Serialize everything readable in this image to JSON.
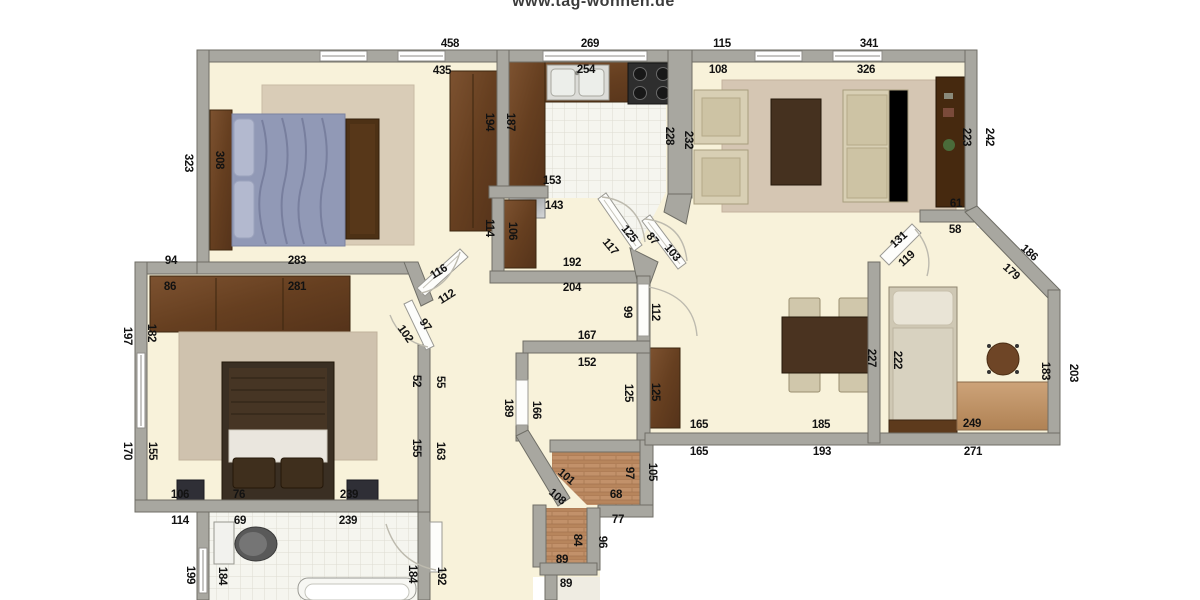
{
  "brand": {
    "url_text": "www.tag-wohnen.de"
  },
  "floorplan": {
    "colors": {
      "wall": "#a8a7a0",
      "wall_edge": "#6f6e66",
      "floor_cream": "#f8f2da",
      "tile": "#f5f5ef",
      "tile_line": "#dddcd2",
      "wood_dark": "#6b4527",
      "rug": "#d7c9b4",
      "bed_blue": "#8d94b2",
      "sofa_cream": "#d8cfb4"
    },
    "labels": [
      {
        "t": "458",
        "x": 450,
        "y": 44
      },
      {
        "t": "269",
        "x": 590,
        "y": 44
      },
      {
        "t": "115",
        "x": 722,
        "y": 44
      },
      {
        "t": "341",
        "x": 869,
        "y": 44
      },
      {
        "t": "435",
        "x": 442,
        "y": 71
      },
      {
        "t": "254",
        "x": 586,
        "y": 70
      },
      {
        "t": "108",
        "x": 718,
        "y": 70
      },
      {
        "t": "326",
        "x": 866,
        "y": 70
      },
      {
        "t": "323",
        "x": 188,
        "y": 163,
        "r": 90
      },
      {
        "t": "308",
        "x": 219,
        "y": 160,
        "r": 90
      },
      {
        "t": "194",
        "x": 489,
        "y": 122,
        "r": 90
      },
      {
        "t": "114",
        "x": 489,
        "y": 228,
        "r": 90
      },
      {
        "t": "283",
        "x": 297,
        "y": 261
      },
      {
        "t": "94",
        "x": 171,
        "y": 261
      },
      {
        "t": "86",
        "x": 170,
        "y": 287
      },
      {
        "t": "281",
        "x": 297,
        "y": 287
      },
      {
        "t": "187",
        "x": 510,
        "y": 122,
        "r": 90
      },
      {
        "t": "228",
        "x": 669,
        "y": 136,
        "r": 90
      },
      {
        "t": "232",
        "x": 688,
        "y": 140,
        "r": 90
      },
      {
        "t": "223",
        "x": 966,
        "y": 137,
        "r": 90
      },
      {
        "t": "242",
        "x": 989,
        "y": 137,
        "r": 90
      },
      {
        "t": "61",
        "x": 956,
        "y": 204
      },
      {
        "t": "58",
        "x": 955,
        "y": 230
      },
      {
        "t": "131",
        "x": 899,
        "y": 240,
        "r": -42
      },
      {
        "t": "119",
        "x": 907,
        "y": 259,
        "r": -42
      },
      {
        "t": "186",
        "x": 1029,
        "y": 253,
        "r": 42
      },
      {
        "t": "179",
        "x": 1011,
        "y": 272,
        "r": 42
      },
      {
        "t": "153",
        "x": 552,
        "y": 181
      },
      {
        "t": "143",
        "x": 554,
        "y": 206
      },
      {
        "t": "106",
        "x": 512,
        "y": 231,
        "r": 90
      },
      {
        "t": "192",
        "x": 572,
        "y": 263
      },
      {
        "t": "204",
        "x": 572,
        "y": 288
      },
      {
        "t": "125",
        "x": 629,
        "y": 234,
        "r": 50
      },
      {
        "t": "117",
        "x": 610,
        "y": 247,
        "r": 50
      },
      {
        "t": "87",
        "x": 652,
        "y": 239,
        "r": 50
      },
      {
        "t": "103",
        "x": 672,
        "y": 253,
        "r": 50
      },
      {
        "t": "99",
        "x": 627,
        "y": 312,
        "r": 90
      },
      {
        "t": "112",
        "x": 655,
        "y": 312,
        "r": 90
      },
      {
        "t": "116",
        "x": 439,
        "y": 272,
        "r": -32
      },
      {
        "t": "112",
        "x": 447,
        "y": 297,
        "r": -32
      },
      {
        "t": "102",
        "x": 405,
        "y": 334,
        "r": 55
      },
      {
        "t": "97",
        "x": 425,
        "y": 325,
        "r": 55
      },
      {
        "t": "197",
        "x": 127,
        "y": 336,
        "r": 90
      },
      {
        "t": "182",
        "x": 151,
        "y": 333,
        "r": 90
      },
      {
        "t": "170",
        "x": 127,
        "y": 451,
        "r": 90
      },
      {
        "t": "155",
        "x": 152,
        "y": 451,
        "r": 90
      },
      {
        "t": "52",
        "x": 416,
        "y": 381,
        "r": 90
      },
      {
        "t": "55",
        "x": 440,
        "y": 382,
        "r": 90
      },
      {
        "t": "155",
        "x": 416,
        "y": 448,
        "r": 90
      },
      {
        "t": "163",
        "x": 440,
        "y": 451,
        "r": 90
      },
      {
        "t": "106",
        "x": 180,
        "y": 495
      },
      {
        "t": "76",
        "x": 239,
        "y": 495
      },
      {
        "t": "239",
        "x": 349,
        "y": 495
      },
      {
        "t": "114",
        "x": 180,
        "y": 521
      },
      {
        "t": "69",
        "x": 240,
        "y": 521
      },
      {
        "t": "239",
        "x": 348,
        "y": 521
      },
      {
        "t": "199",
        "x": 190,
        "y": 575,
        "r": 90
      },
      {
        "t": "184",
        "x": 222,
        "y": 576,
        "r": 90
      },
      {
        "t": "184",
        "x": 412,
        "y": 574,
        "r": 90
      },
      {
        "t": "192",
        "x": 441,
        "y": 576,
        "r": 90
      },
      {
        "t": "189",
        "x": 508,
        "y": 408,
        "r": 90
      },
      {
        "t": "166",
        "x": 536,
        "y": 410,
        "r": 90
      },
      {
        "t": "167",
        "x": 587,
        "y": 336
      },
      {
        "t": "152",
        "x": 587,
        "y": 363
      },
      {
        "t": "125",
        "x": 628,
        "y": 393,
        "r": 90
      },
      {
        "t": "125",
        "x": 655,
        "y": 392,
        "r": 90
      },
      {
        "t": "165",
        "x": 699,
        "y": 425
      },
      {
        "t": "185",
        "x": 821,
        "y": 425
      },
      {
        "t": "165",
        "x": 699,
        "y": 452
      },
      {
        "t": "193",
        "x": 822,
        "y": 452
      },
      {
        "t": "227",
        "x": 871,
        "y": 358,
        "r": 90
      },
      {
        "t": "222",
        "x": 897,
        "y": 360,
        "r": 90
      },
      {
        "t": "249",
        "x": 972,
        "y": 424
      },
      {
        "t": "271",
        "x": 973,
        "y": 452
      },
      {
        "t": "183",
        "x": 1045,
        "y": 371,
        "r": 90
      },
      {
        "t": "203",
        "x": 1073,
        "y": 373,
        "r": 90
      },
      {
        "t": "101",
        "x": 566,
        "y": 477,
        "r": 40
      },
      {
        "t": "108",
        "x": 557,
        "y": 497,
        "r": 40
      },
      {
        "t": "97",
        "x": 629,
        "y": 473,
        "r": 90
      },
      {
        "t": "105",
        "x": 652,
        "y": 472,
        "r": 90
      },
      {
        "t": "68",
        "x": 616,
        "y": 495
      },
      {
        "t": "77",
        "x": 618,
        "y": 520
      },
      {
        "t": "84",
        "x": 577,
        "y": 540,
        "r": 90
      },
      {
        "t": "96",
        "x": 602,
        "y": 542,
        "r": 90
      },
      {
        "t": "89",
        "x": 562,
        "y": 560
      },
      {
        "t": "89",
        "x": 566,
        "y": 584
      }
    ]
  }
}
